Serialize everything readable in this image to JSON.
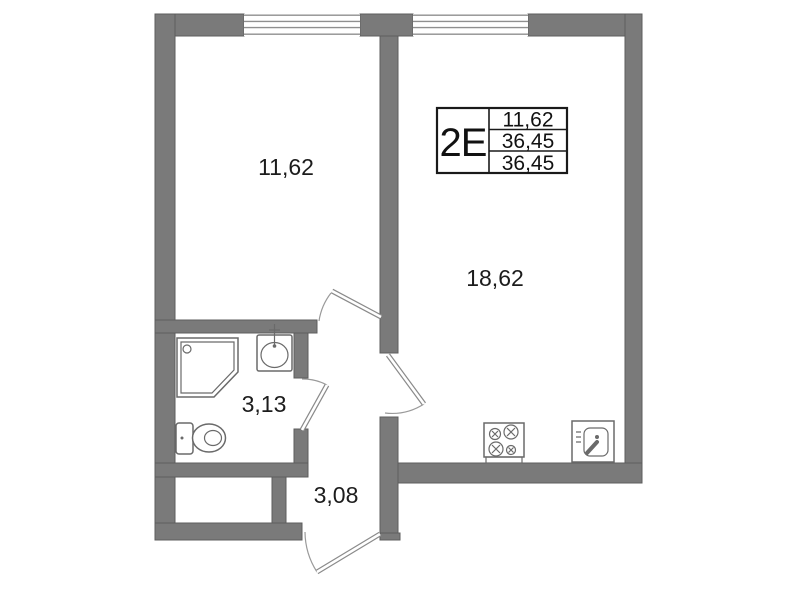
{
  "unit": {
    "type_label": "2Е",
    "area_rows": [
      "11,62",
      "36,45",
      "36,45"
    ]
  },
  "rooms": {
    "bedroom": {
      "area": "11,62"
    },
    "living_kitchen": {
      "area": "18,62"
    },
    "bathroom": {
      "area": "3,13"
    },
    "hallway": {
      "area": "3,08"
    }
  },
  "fixtures": [
    "shower-icon",
    "washbasin-icon",
    "toilet-icon",
    "stove-icon",
    "kitchen-sink-icon"
  ],
  "windows_count": 2,
  "doors_count": 4,
  "colors": {
    "background": "#ffffff",
    "wall_fill": "#7a7a7a",
    "wall_edge": "#5d5d5d",
    "window_line": "#8f8f8f",
    "fixture_line": "#6a6a6a",
    "table_border": "#1a1a1a",
    "label_text": "#1c1c1c"
  }
}
